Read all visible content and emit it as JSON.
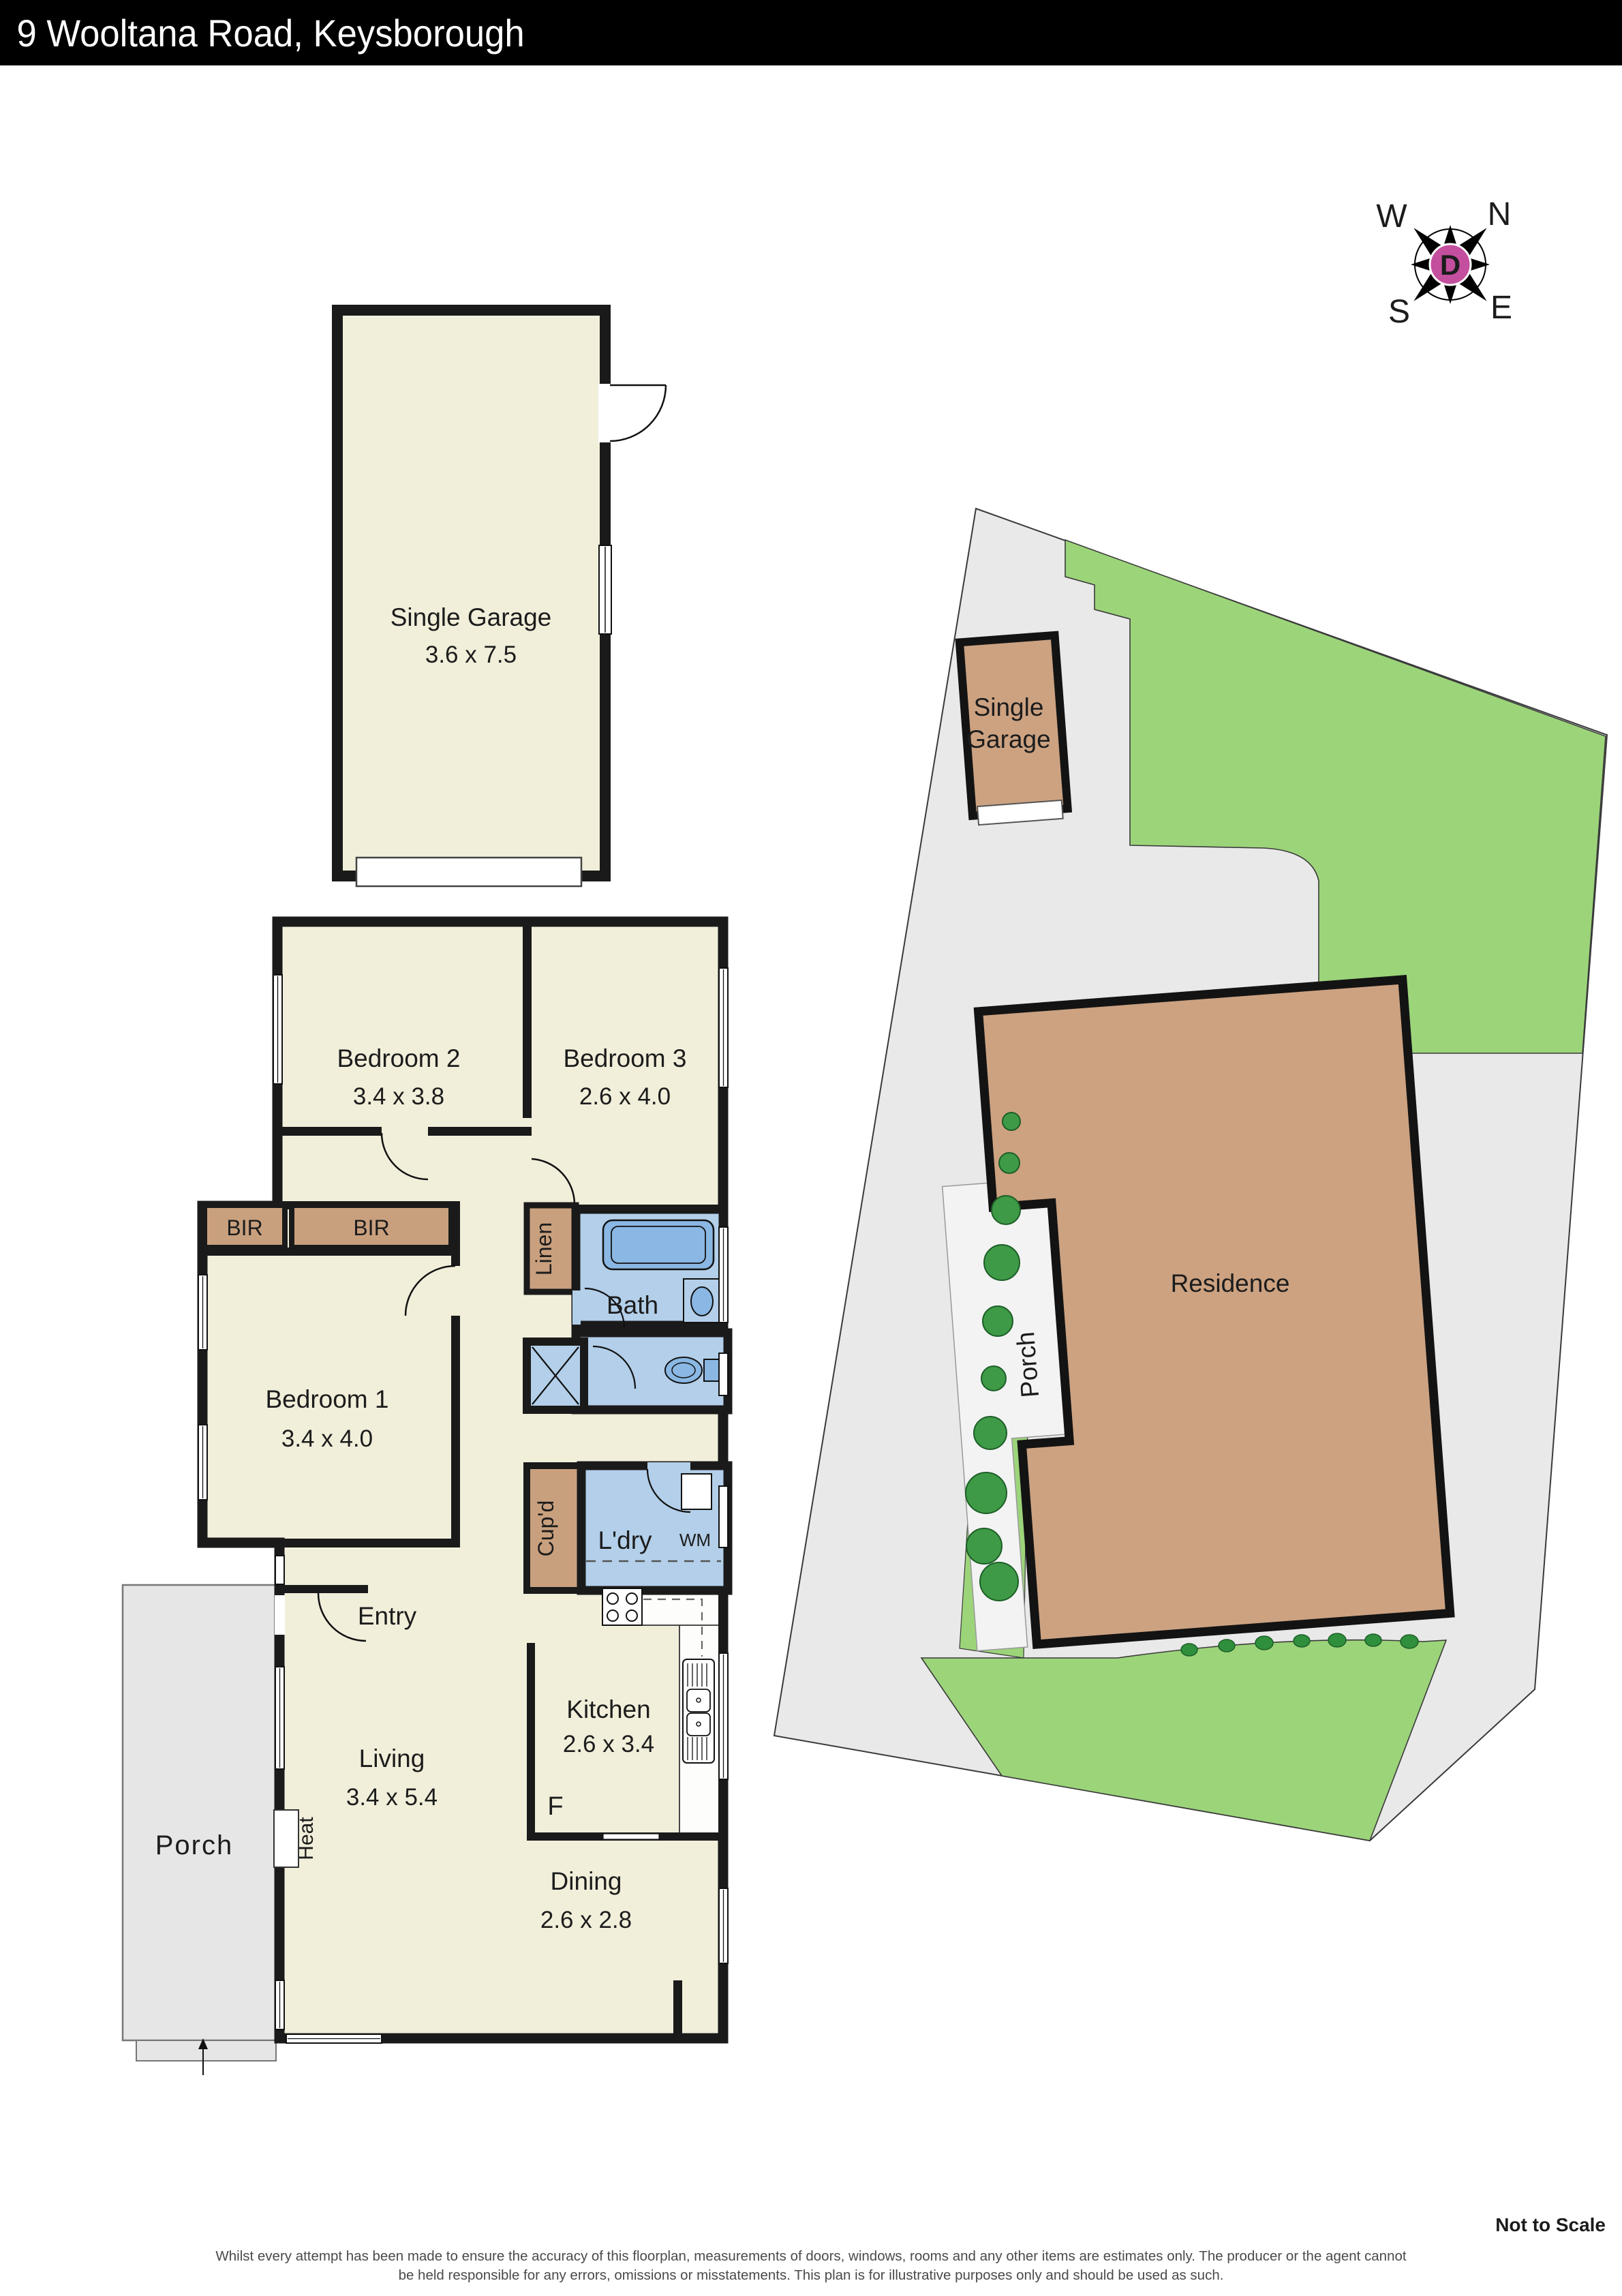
{
  "header": {
    "title": "9 Wooltana Road, Keysborough"
  },
  "compass": {
    "w": "W",
    "n": "N",
    "s": "S",
    "e": "E",
    "center": "D"
  },
  "floorplan": {
    "garage": {
      "label": "Single Garage",
      "dims": "3.6 x 7.5"
    },
    "bedroom2": {
      "label": "Bedroom 2",
      "dims": "3.4 x 3.8"
    },
    "bedroom3": {
      "label": "Bedroom 3",
      "dims": "2.6 x 4.0"
    },
    "bedroom1": {
      "label": "Bedroom 1",
      "dims": "3.4 x 4.0"
    },
    "kitchen": {
      "label": "Kitchen",
      "dims": "2.6 x 3.4"
    },
    "living": {
      "label": "Living",
      "dims": "3.4 x 5.4"
    },
    "dining": {
      "label": "Dining",
      "dims": "2.6 x 2.8"
    },
    "bath": {
      "label": "Bath"
    },
    "bir1": {
      "label": "BIR"
    },
    "bir2": {
      "label": "BIR"
    },
    "linen": {
      "label": "Linen"
    },
    "cupd": {
      "label": "Cup'd"
    },
    "ldry": {
      "label": "L'dry"
    },
    "wm": {
      "label": "WM"
    },
    "heat": {
      "label": "Heat"
    },
    "entry": {
      "label": "Entry"
    },
    "fridge": {
      "label": "F"
    },
    "porch": {
      "label": "Porch"
    }
  },
  "siteplan": {
    "garage_line1": "Single",
    "garage_line2": "Garage",
    "residence": "Residence",
    "porch": "Porch"
  },
  "footer": {
    "scale_note": "Not to Scale",
    "disclaimer_line1": "Whilst every attempt has been made to ensure the accuracy of this floorplan, measurements of doors, windows, rooms and any other items are estimates only. The producer or the agent cannot",
    "disclaimer_line2": "be held responsible for any errors, omissions or misstatements. This plan is for illustrative purposes only and should be used as such."
  },
  "colors": {
    "wall": "#1a1a1a",
    "room_fill": "#f1eeda",
    "wet_fill": "#b3cfe9",
    "fixture_fill": "#8ab7e3",
    "robe_fill": "#c9a07e",
    "porch_fill": "#e6e6e6",
    "lawn": "#9cd47a",
    "tree": "#3e9a46",
    "paving": "#e9e9e9",
    "building": "#cca281",
    "compass_accent": "#c44f9e"
  }
}
